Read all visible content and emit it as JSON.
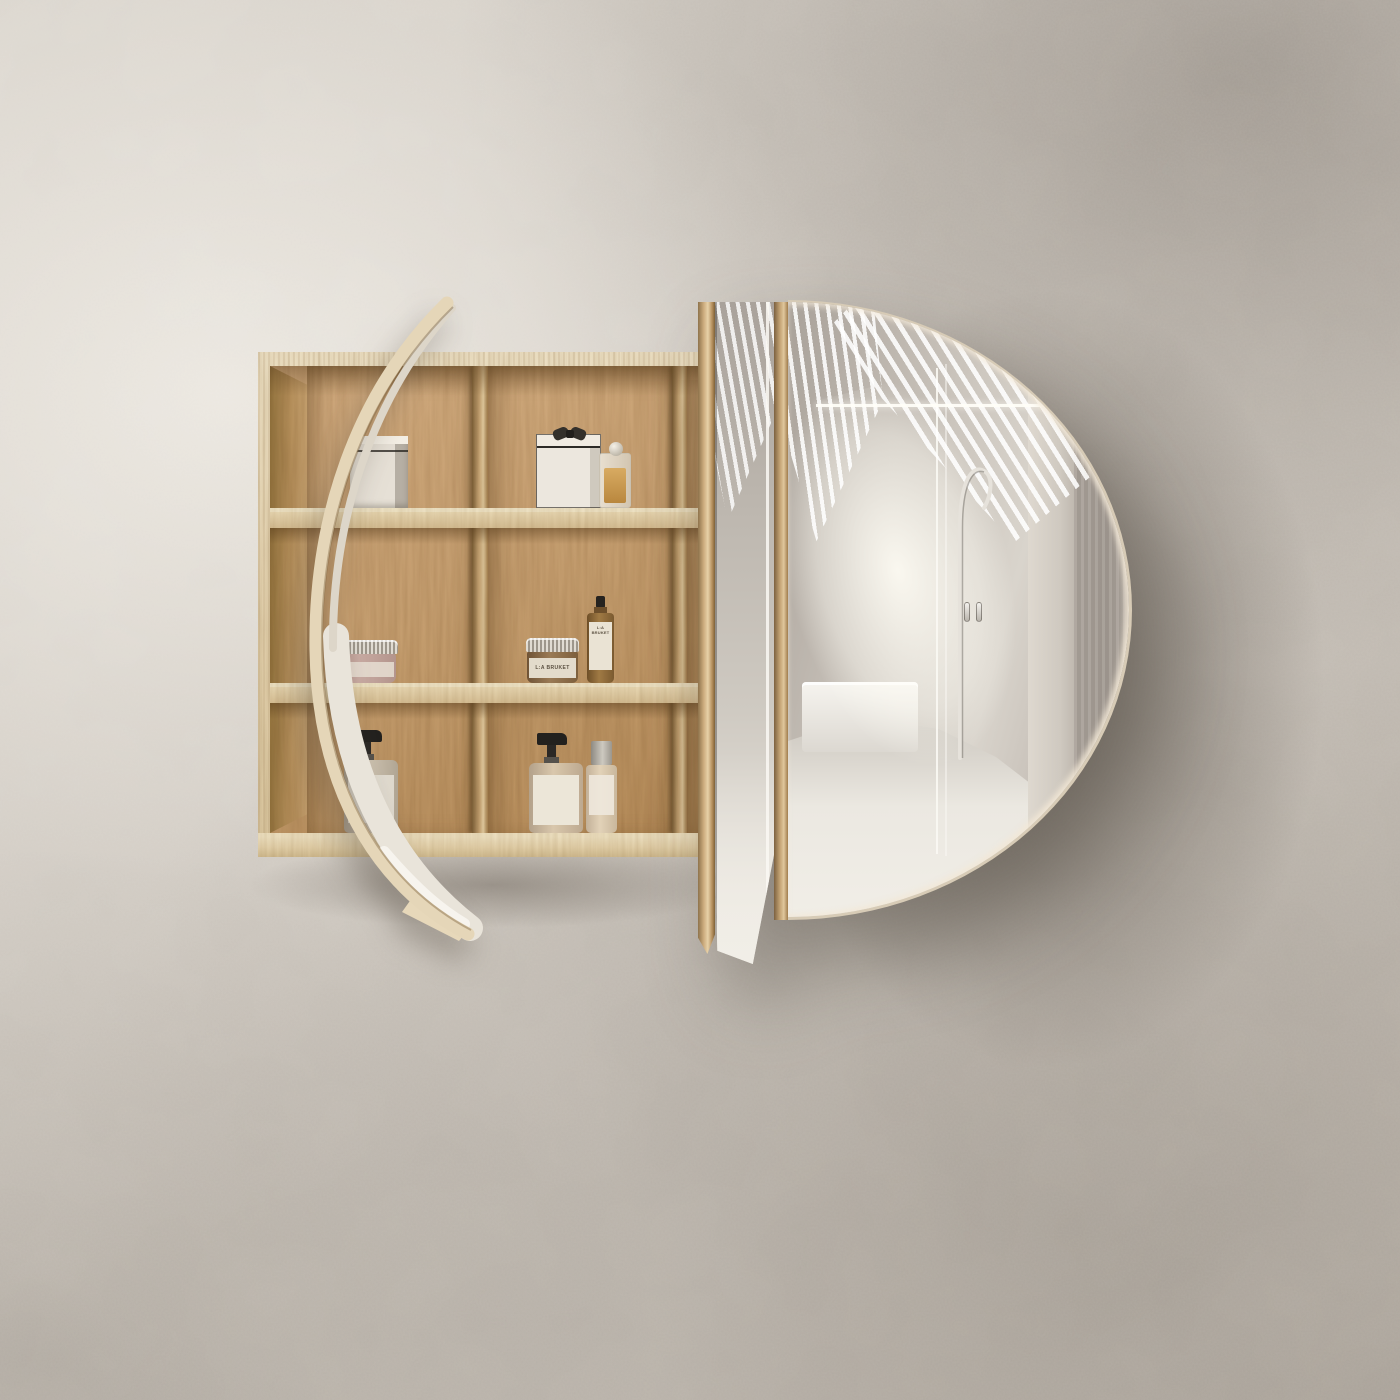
{
  "scene": {
    "title": "Oval mirrored bathroom shelving cabinet",
    "description": "Wall-mounted light-oak shelving cabinet with a large pill-shaped mirror door slid open to the right, revealing three shelves of toiletries; a second slim mirrored door stands open edge-on at the left as a curved sliver. Textured warm-grey plaster wall; the mirror reflects a sunlit bathroom with slatted light, a frameless glass shower door and a freestanding tub filler.",
    "wall": "textured warm-grey plaster with soft daylight from the upper left",
    "lighting": "deep soft shadow cast on the wall to the lower right of the mirror door"
  },
  "palette": {
    "wall_light": "#dcd7cf",
    "wall_mid": "#c6c0b8",
    "wall_shadow": "#8e867d",
    "oak_light": "#e9d9b9",
    "oak_mid": "#c7a173",
    "oak_dark": "#96713f",
    "mirror_bright": "#f6f3ed",
    "mirror_grey": "#b8b2aa",
    "mirror_dark": "#a39c94",
    "black_accent": "#2e2b27",
    "amber_glass": "#9a7434",
    "chrome": "#e3dfd9"
  },
  "cabinet": {
    "material": "light oak with rough-sawn vertical grain",
    "columns": 3,
    "rows": 3,
    "shelf_boards": 2,
    "description": "Open oak carcass with two shelf boards and two vertical dividers; the right third is concealed behind the sliding mirror door."
  },
  "doors": {
    "left_open_door": "slim pill-shaped mirror door standing open, seen edge-on as a curved oak sliver with a strip of mirror catching the bright floor",
    "main_door": "large D-shaped pill mirror door slid to the right, oak-edged, with a slim rectangular mirror panel and oak stile on its left",
    "reflection_elements": [
      "fan of bright slatted-light stripes across ceiling and wall",
      "sunbeam washing down the concrete wall",
      "frameless glass shower door with two chrome handles",
      "freestanding chrome tub filler with hooked spout",
      "white bathtub rim",
      "pale polished concrete floor"
    ]
  },
  "products": {
    "silver_box": {
      "shelf": "top",
      "bay": "left",
      "description": "brushed-metal keepsake box with dark seam line",
      "label_text": ""
    },
    "gift_box": {
      "shelf": "top",
      "bay": "middle",
      "description": "cream gift box with black ribbon bow",
      "label_text": ""
    },
    "perfume_bottle": {
      "shelf": "top",
      "bay": "middle",
      "description": "clear glass perfume bottle with amber fragrance and glass ball stopper",
      "label_text": ""
    },
    "cream_jar": {
      "shelf": "middle",
      "bay": "left",
      "description": "mauve-pink cream jar with ribbed aluminium lid and pale label",
      "label_text": ""
    },
    "labruket_jar": {
      "shelf": "middle",
      "bay": "middle",
      "description": "amber glass jar with ribbed aluminium lid and kraft label",
      "label_text": "L:A BRUKET"
    },
    "labruket_bottle": {
      "shelf": "middle",
      "bay": "middle",
      "description": "amber glass bottle with white apothecary label and black cap",
      "label_text": "L:A BRUKET"
    },
    "soap_pump": {
      "shelf": "bottom",
      "bay": "left",
      "description": "grey-beige soap bottle with black pump and printed apothecary label",
      "label_text": ""
    },
    "lotion_pump": {
      "shelf": "bottom",
      "bay": "middle",
      "description": "beige lotion bottle with black pump and white label",
      "label_text": ""
    },
    "spray_bottle": {
      "shelf": "bottom",
      "bay": "middle",
      "description": "beige mist bottle with tall grey cap and small label",
      "label_text": ""
    }
  }
}
